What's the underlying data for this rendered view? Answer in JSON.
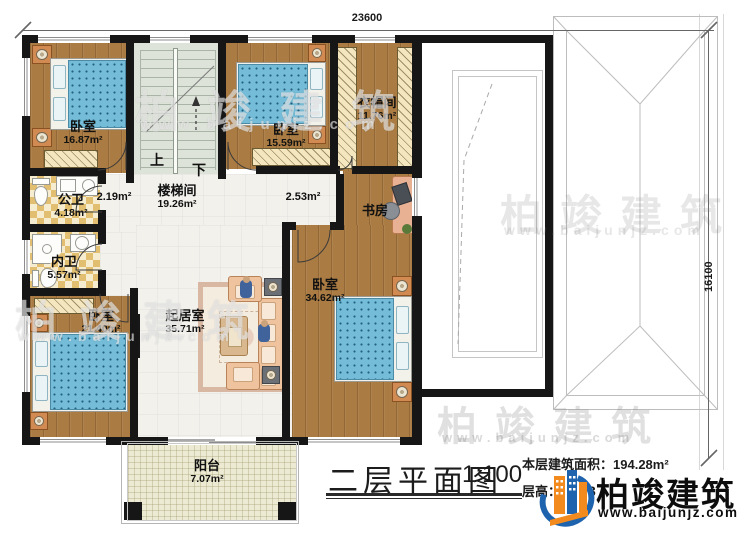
{
  "dimensions": {
    "width_mm": "23600",
    "height_mm": "16100"
  },
  "rooms": {
    "bedroom1": {
      "name": "卧室",
      "area": "16.87m²"
    },
    "bedroom2": {
      "name": "卧室",
      "area": "15.59m²"
    },
    "cloakroom": {
      "name": "衣帽间",
      "area": "11.76m²"
    },
    "stairwell": {
      "name": "楼梯间",
      "area": "19.26m²"
    },
    "hall_left": {
      "area": "2.19m²"
    },
    "hall_right": {
      "area": "2.53m²"
    },
    "study": {
      "name": "书房"
    },
    "public_bath": {
      "name": "公卫",
      "area": "4.18m²"
    },
    "private_bath": {
      "name": "内卫",
      "area": "5.57m²"
    },
    "bedroom3": {
      "name": "卧室",
      "area": "21.40m²"
    },
    "living": {
      "name": "起居室",
      "area": "35.71m²"
    },
    "bedroom4": {
      "name": "卧室",
      "area": "34.62m²"
    },
    "balcony": {
      "name": "阳台",
      "area": "7.07m²"
    }
  },
  "stairs": {
    "up": "上",
    "down": "下"
  },
  "title_block": {
    "title": "二层平面图",
    "scale": "1:100",
    "floor_area_label": "本层建筑面积：",
    "floor_area_value": "194.28m²",
    "floor_height_label": "层高：",
    "floor_height_visible": "3"
  },
  "brand": {
    "name": "柏竣建筑",
    "url": "www.baijunjz.com"
  },
  "watermark": {
    "name": "柏竣建筑",
    "url": "www.baijunjz.com"
  },
  "colors": {
    "brand_blue": "#1e63ad",
    "brand_orange": "#f28a1e",
    "wall": "#161616",
    "bed_blue": "#74bcd8"
  }
}
